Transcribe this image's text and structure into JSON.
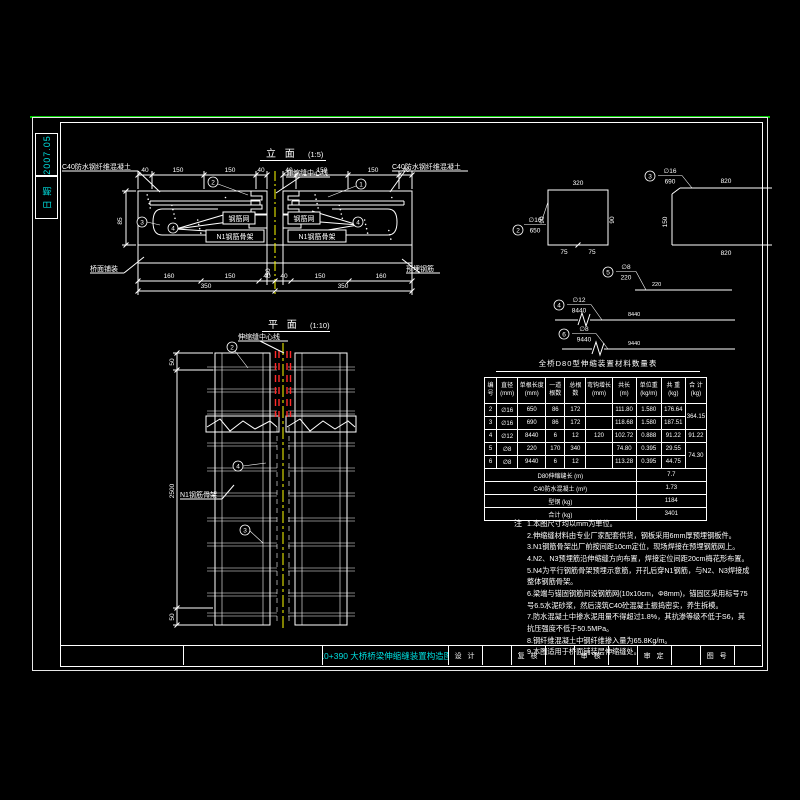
{
  "meta": {
    "date_label": "日 期",
    "date_value": "2007.05"
  },
  "titleblock": {
    "drawing_title": "K0+390 大桥桥梁伸缩缝装置构造图",
    "fields": [
      {
        "label": "设 计"
      },
      {
        "label": "复 核"
      },
      {
        "label": "审 核"
      },
      {
        "label": "审 定"
      },
      {
        "label": "图 号"
      }
    ]
  },
  "elevation": {
    "title": "立 面",
    "scale": "(1:5)",
    "labels": {
      "c40_left": "C40防水钢纤维混凝土",
      "c40_right": "C40防水钢纤维混凝土",
      "centerline": "伸缩缝中心线",
      "mesh_left": "钢筋网",
      "mesh_right": "钢筋网",
      "n1_left": "N1钢筋骨架",
      "n1_right": "N1钢筋骨架",
      "pavement": "桥面铺装",
      "embed": "预埋钢筋"
    },
    "dims": {
      "t1": "40",
      "t2": "150",
      "t3": "150",
      "t4": "40",
      "t5": "40",
      "t6": "150",
      "t7": "150",
      "t8": "40",
      "h": "85",
      "g1": "30",
      "g2": "40",
      "b1": "160",
      "b2": "150",
      "b3": "40",
      "b4": "40",
      "b5": "150",
      "b6": "160",
      "o1": "350",
      "o2": "350"
    },
    "marks": {
      "m1": "3",
      "m2": "4",
      "m3": "2",
      "m4": "1",
      "m5": "4"
    }
  },
  "plan": {
    "title": "平 面",
    "scale": "(1:10)",
    "labels": {
      "centerline": "伸缩缝中心线",
      "n1": "N1钢筋骨架"
    },
    "dims": {
      "top": "50",
      "mid": "2500",
      "bot": "50"
    },
    "marks": {
      "p1": "2",
      "p2": "4",
      "p3": "3"
    }
  },
  "details": {
    "d2": {
      "num": "2",
      "dia": "∅16",
      "len": "650",
      "top": "320",
      "left": "90",
      "right": "90",
      "bot1": "75",
      "bot2": "75"
    },
    "d3": {
      "num": "3",
      "dia": "∅16",
      "len": "690",
      "top": "820",
      "side": "150",
      "bottom": "820"
    },
    "d5": {
      "num": "5",
      "dia": "∅8",
      "len": "220",
      "line": "220"
    },
    "d4": {
      "num": "4",
      "dia": "∅12",
      "len": "8440",
      "line": "8440"
    },
    "d6": {
      "num": "6",
      "dia": "∅8",
      "len": "9440",
      "line": "9440"
    }
  },
  "material_table": {
    "title": "全桥D80型伸缩装置材料数量表",
    "headers": [
      "编\n号",
      "直径\n(mm)",
      "单根长度\n(mm)",
      "一道\n根数",
      "总根\n数",
      "弯钩增长\n(mm)",
      "共长\n(m)",
      "单位重\n(kg/m)",
      "共 重\n(kg)",
      "合 计\n(kg)"
    ],
    "rows": [
      {
        "c0": "2",
        "c1": "∅16",
        "c2": "650",
        "c3": "86",
        "c4": "172",
        "c5": "",
        "c6": "111.80",
        "c7": "1.580",
        "c8": "176.64",
        "total": "364.15"
      },
      {
        "c0": "3",
        "c1": "∅16",
        "c2": "690",
        "c3": "86",
        "c4": "172",
        "c5": "",
        "c6": "118.68",
        "c7": "1.580",
        "c8": "187.51"
      },
      {
        "c0": "4",
        "c1": "∅12",
        "c2": "8440",
        "c3": "6",
        "c4": "12",
        "c5": "120",
        "c6": "102.72",
        "c7": "0.888",
        "c8": "91.22",
        "total": "91.22"
      },
      {
        "c0": "5",
        "c1": "∅8",
        "c2": "220",
        "c3": "170",
        "c4": "340",
        "c5": "",
        "c6": "74.80",
        "c7": "0.395",
        "c8": "29.55",
        "total": "74.30"
      },
      {
        "c0": "6",
        "c1": "∅8",
        "c2": "9440",
        "c3": "6",
        "c4": "12",
        "c5": "",
        "c6": "113.28",
        "c7": "0.395",
        "c8": "44.75"
      }
    ],
    "footer": [
      {
        "label": "D80伸缩缝长  (m)",
        "value": "7.7"
      },
      {
        "label": "C40防水混凝土  (m³)",
        "value": "1.73"
      },
      {
        "label": "型钢  (kg)",
        "value": "1184"
      },
      {
        "label": "合计  (kg)",
        "value": "3401"
      }
    ]
  },
  "notes": {
    "heading": "注",
    "items": [
      "1.本图尺寸均以mm为单位。",
      "2.伸缩缝材料由专业厂家配套供货，钢板采用6mm厚预埋钢板件。",
      "3.N1钢筋骨架出厂前按间距10cm定位，现场焊接在预埋钢筋网上。",
      "4.N2、N3预埋筋沿伸缩缝方向布置，焊接定位间距20cm梅花形布置。",
      "5.N4为平行钢筋骨架预埋示意筋，开孔后穿N1钢筋，与N2、N3焊接成整体钢筋骨架。",
      "6.梁端与锚固钢筋间设钢筋网(10x10cm，Φ8mm)，锚固区采用标号75号6.5水泥砂浆，然后浇筑C40砼混凝土振捣密实，养生拆模。",
      "7.防水混凝土中掺水泥用量不得超过1.8%，其抗渗等级不低于S6，其抗压强度不低于50.5MPa。",
      "8.钢纤维混凝土中钢纤维掺入量为65.8Kg/m。",
      "9.本图适用于桥面铺装层伸缩缝处。"
    ]
  }
}
